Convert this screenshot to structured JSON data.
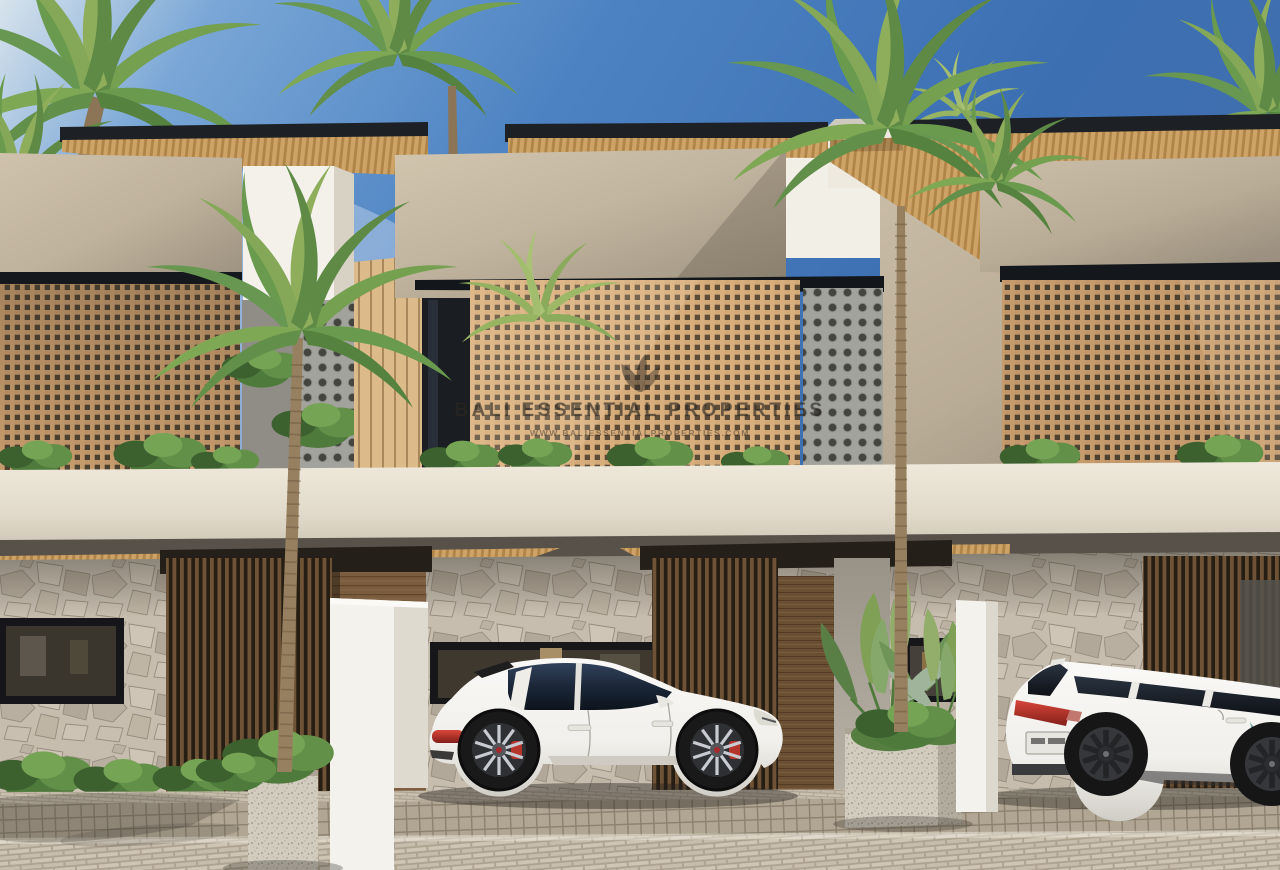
{
  "image": {
    "kind": "architectural-exterior-render",
    "subject": "Row of three modern tropical two-storey townhouses with wooden lattice screens, stone ground floor, palm trees and two parked white cars",
    "time_of_day": "daytime clear sky"
  },
  "watermark": {
    "logo_icon": "leaf-logo-icon",
    "title": "BALI ESSENTIAL PROPERTIES",
    "subtitle": "WWW.BALIESSENTIALPROPERTIES.COM"
  },
  "vehicles": [
    {
      "name": "white SUV side view (Porsche Macan style)",
      "body_color": "#F3F2EF",
      "accent": "red brake calipers and tail light"
    },
    {
      "name": "white compact SUV rear view (Honda HR-V style)",
      "body_color": "#F2F1EE",
      "accent": "red tail lights, white license plate"
    }
  ],
  "palette": {
    "sky_deep": "#3C6FB2",
    "sky_mid": "#5B92D2",
    "sky_haze": "#D7E3EC",
    "roof_fascia": "#1D2024",
    "wood_soffit": "#C9A067",
    "stucco_light": "#CDC0AA",
    "stucco_shadow": "#A39884",
    "white_wall": "#F3F1EA",
    "lattice_wood": "#C79C6C",
    "lattice_hole": "#4D4130",
    "breeze_block": "#A3A39D",
    "stone_wall": "#C6BDAF",
    "slat_screen_dark": "#2E241A",
    "door_wood": "#7A5C3E",
    "slab_cream": "#E6DFD0",
    "pavement": "#CBC1B0",
    "plant_green": "#6E9457",
    "palm_green": "#74A050",
    "trunk_brown": "#97805F",
    "tail_light_red": "#B5342B"
  }
}
